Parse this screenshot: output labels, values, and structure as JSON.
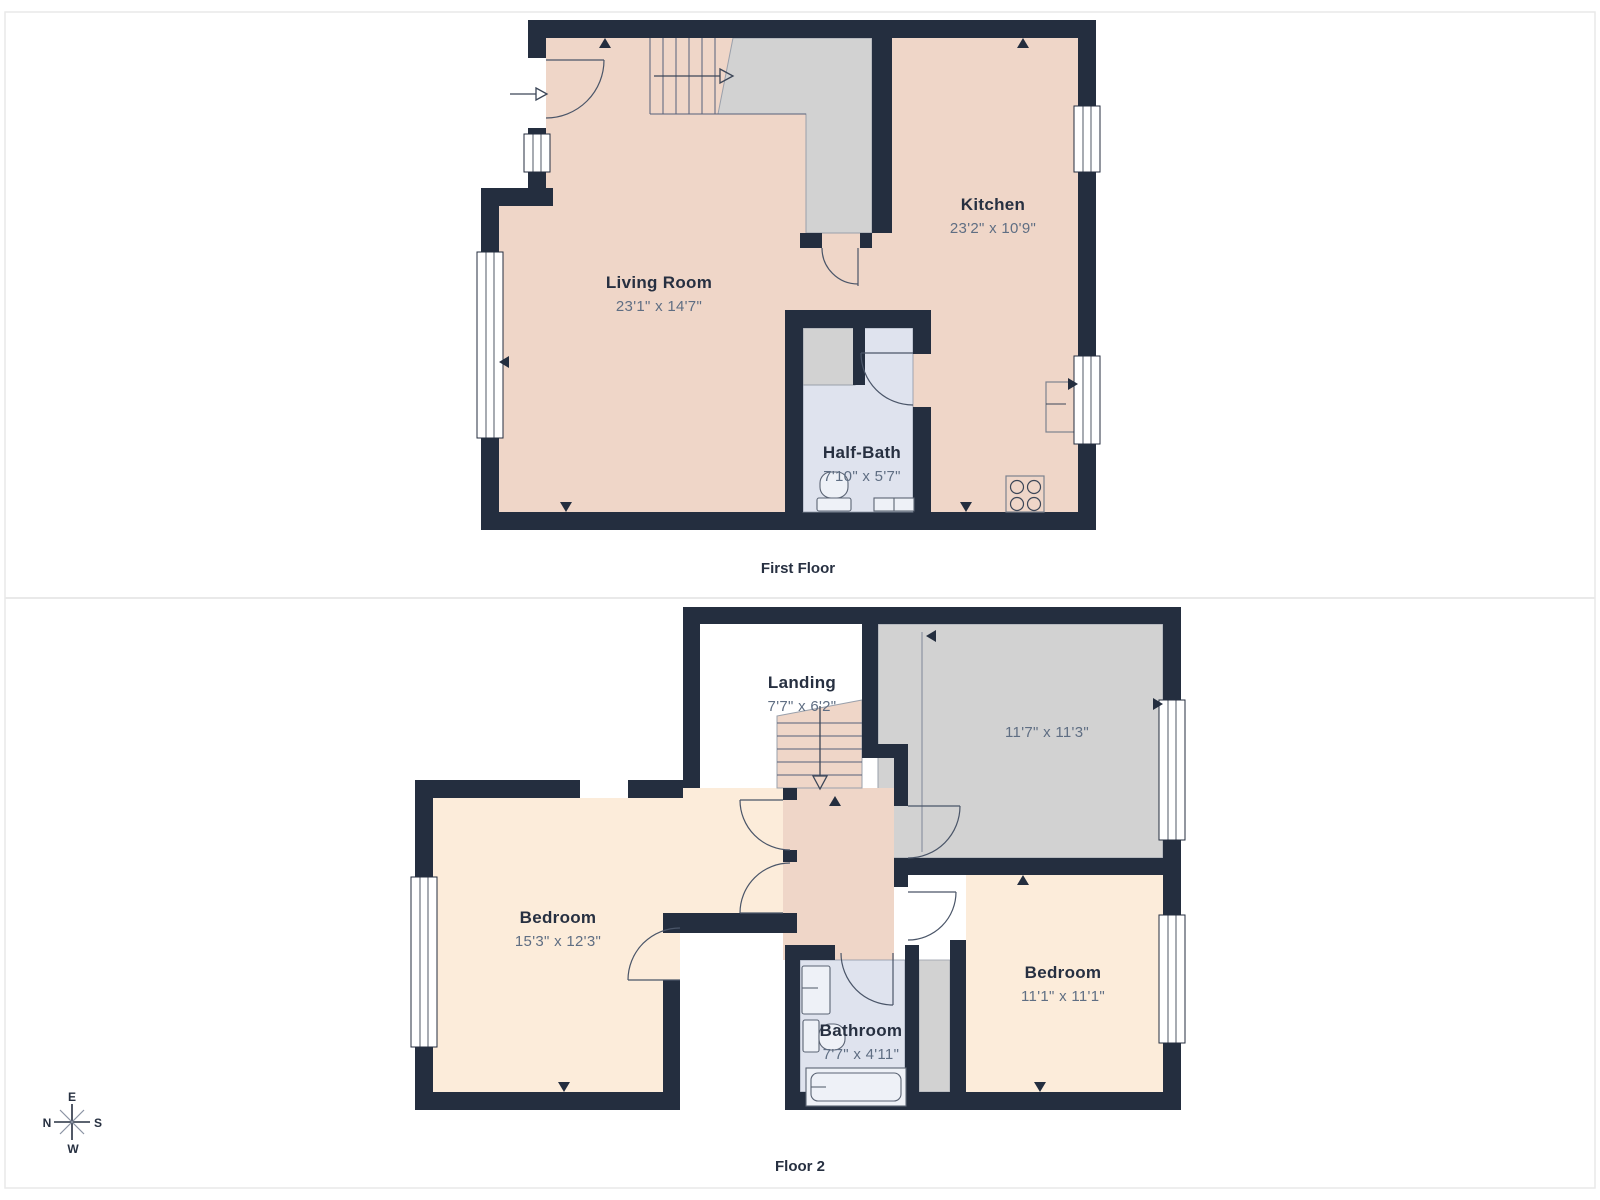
{
  "first_floor": {
    "caption": "First Floor",
    "living_room": {
      "name": "Living Room",
      "dims": "23'1\" x 14'7\""
    },
    "kitchen": {
      "name": "Kitchen",
      "dims": "23'2\" x 10'9\""
    },
    "half_bath": {
      "name": "Half-Bath",
      "dims": "7'10\" x 5'7\""
    }
  },
  "floor_2": {
    "caption": "Floor 2",
    "landing": {
      "name": "Landing",
      "dims": "7'7\" x 6'2\""
    },
    "unlabeled_room": {
      "dims": "11'7\" x 11'3\""
    },
    "bedroom_left": {
      "name": "Bedroom",
      "dims": "15'3\" x 12'3\""
    },
    "bedroom_right": {
      "name": "Bedroom",
      "dims": "11'1\" x 11'1\""
    },
    "bathroom": {
      "name": "Bathroom",
      "dims": "7'7\" x 4'11\""
    }
  },
  "compass": {
    "north": "N",
    "east": "E",
    "south": "S",
    "west": "W"
  },
  "colors": {
    "wall": "#242e3f",
    "floor_warm": "#efd6c8",
    "floor_cream": "#fcecda",
    "floor_bath": "#dfe3ee",
    "floor_grey": "#d2d2d2",
    "title_text": "#273041",
    "dims_text": "#5f6e83",
    "panel_border": "#e9e9e9"
  }
}
